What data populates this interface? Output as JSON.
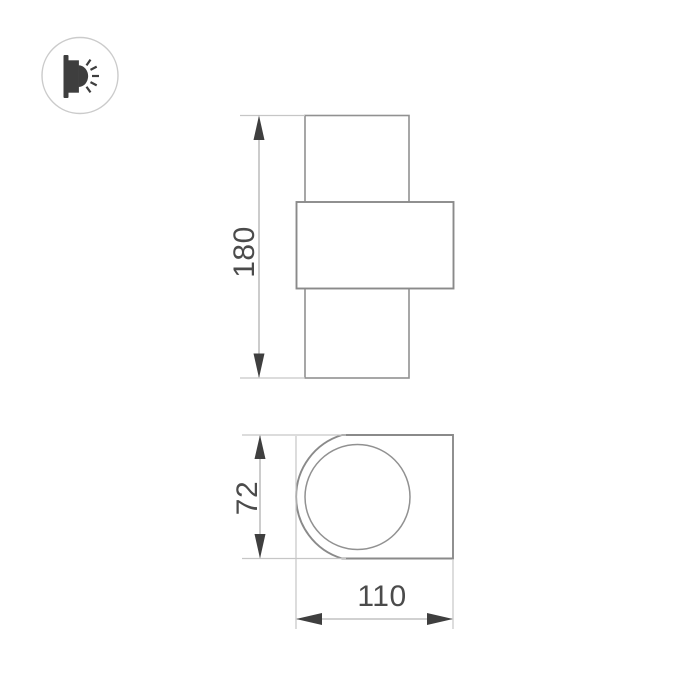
{
  "drawing": {
    "kind": "technical-dimension-drawing",
    "dimensions": {
      "height_label": "180",
      "depth_label": "72",
      "width_label": "110"
    },
    "colors": {
      "background": "#ffffff",
      "body_outline": "#919191",
      "plate_outline": "#8a8a8a",
      "extension_line": "#c6c6c6",
      "dimension_line": "#a3a3a3",
      "arrow": "#3f3f3f",
      "label_text": "#4b4b4b",
      "icon": "#3e3e3e",
      "badge_ring": "#cbcbcb"
    },
    "icons": [
      {
        "name": "wall-light-icon",
        "meaning": "wall-mounted luminaire emitting light sideways"
      }
    ]
  }
}
